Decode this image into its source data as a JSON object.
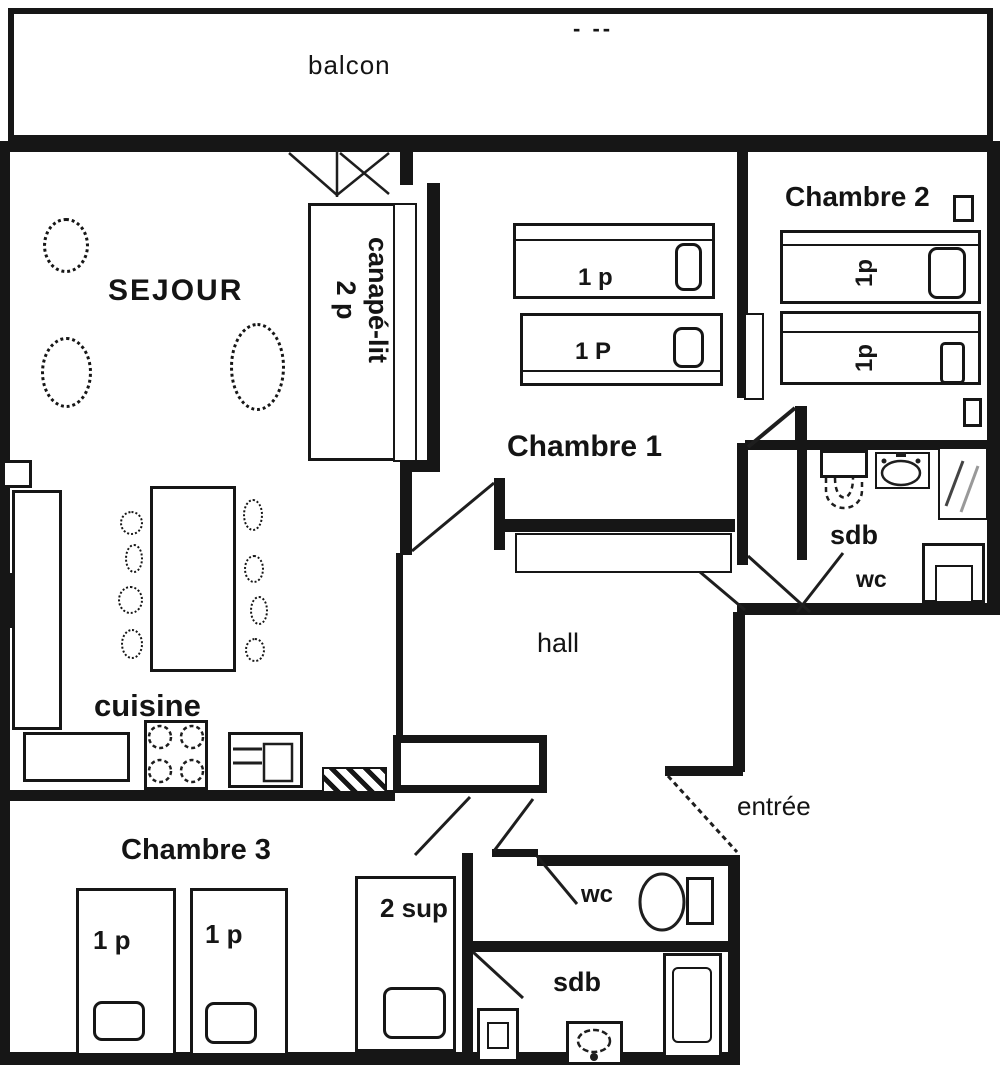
{
  "colors": {
    "wall": "#161616",
    "background": "#ffffff",
    "mirror_line_dark": "#444444",
    "mirror_line_light": "#999999"
  },
  "labels": {
    "balcony": "balcon",
    "balcony_marks": "- --",
    "living": "SEJOUR",
    "sofa_line1": "canapé-lit",
    "sofa_line2": "2 p",
    "room1": "Chambre 1",
    "room2": "Chambre 2",
    "room3": "Chambre 3",
    "kitchen": "cuisine",
    "hall": "hall",
    "entrance": "entrée",
    "bath_right": "sdb",
    "wc_right": "wc",
    "wc_bottom": "wc",
    "bath_bottom": "sdb",
    "bed_room1_a": "1 p",
    "bed_room1_b": "1 P",
    "bed_room2_a": "1p",
    "bed_room2_b": "1p",
    "bed_room3_a": "1 p",
    "bed_room3_b": "1 p",
    "bed_room3_c": "2 sup"
  }
}
